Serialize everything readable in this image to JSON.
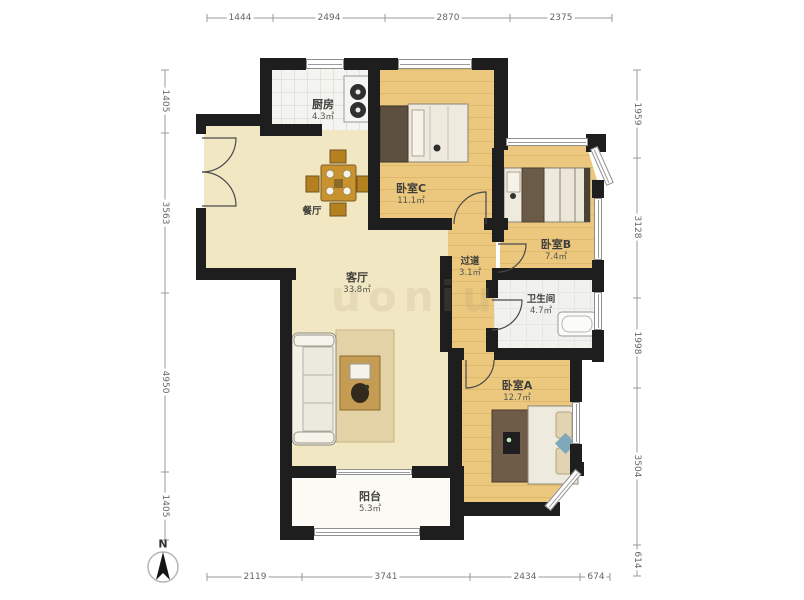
{
  "floorplan": {
    "rooms": {
      "kitchen": {
        "name": "厨房",
        "area": "4.3㎡"
      },
      "bedroom_c": {
        "name": "卧室C",
        "area": "11.1㎡"
      },
      "bedroom_b": {
        "name": "卧室B",
        "area": "7.4㎡"
      },
      "bedroom_a": {
        "name": "卧室A",
        "area": "12.7㎡"
      },
      "dining": {
        "name": "餐厅"
      },
      "living": {
        "name": "客厅",
        "area": "33.8㎡"
      },
      "hallway": {
        "name": "过道",
        "area": "3.1㎡"
      },
      "bathroom": {
        "name": "卫生间",
        "area": "4.7㎡"
      },
      "balcony": {
        "name": "阳台",
        "area": "5.3㎡"
      }
    },
    "dimensions_mm": {
      "top": [
        "1444",
        "2494",
        "2870",
        "2375"
      ],
      "left": [
        "1405",
        "3563",
        "4950",
        "1405"
      ],
      "right": [
        "1959",
        "3128",
        "1998",
        "3504",
        "614"
      ],
      "bottom": [
        "2119",
        "3741",
        "2434",
        "674"
      ]
    },
    "compass": {
      "label": "N"
    },
    "watermark_text": "uoniu",
    "colors": {
      "wall": "#1e1e1e",
      "wood_floor": "#ebc87e",
      "cream_floor": "#f1e7c3",
      "tile_floor": "#f4f4f1",
      "balcony_floor": "#fbfaf5"
    }
  }
}
